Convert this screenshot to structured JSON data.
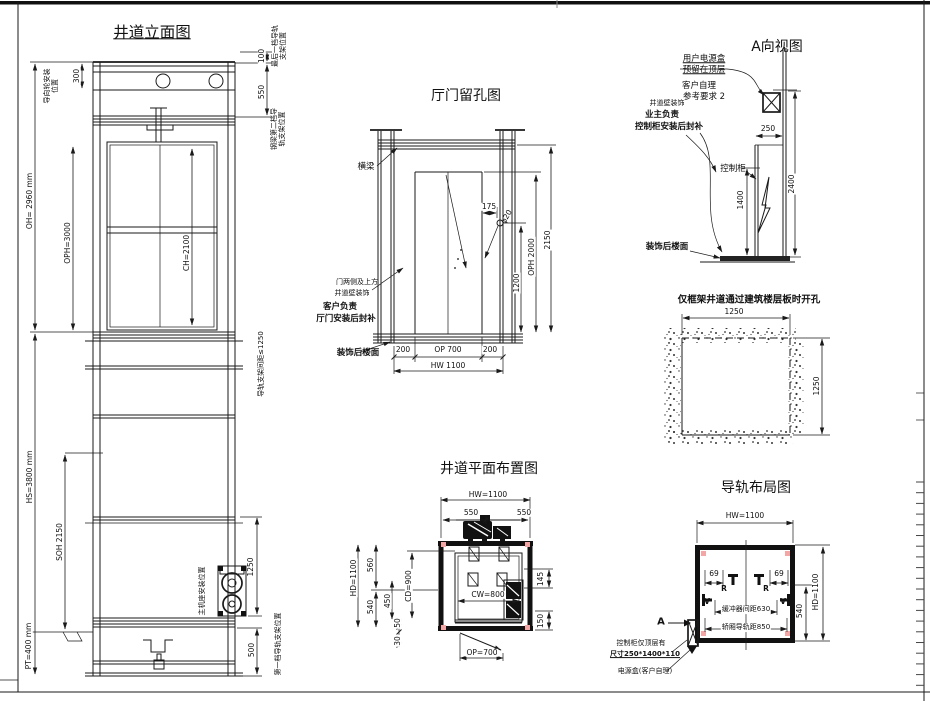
{
  "colors": {
    "line": "#1a1a1a",
    "accent_pink": "#f2a6a6",
    "background": "#ffffff"
  },
  "elevation": {
    "title": "井道立面图",
    "dims": {
      "d300": "300",
      "oh": "OH= 2960 mm",
      "oph": "OPH=3000",
      "ch": "CH=2100",
      "hs": "HS=3800 mm",
      "soh": "SOH 2150",
      "pt": "PT=400 mm",
      "d100": "100",
      "d550": "550",
      "spacing": "导轨支架间距≤1250",
      "d1250": "1250",
      "d500": "500"
    },
    "labels": {
      "guide_wheel": "导向轮安装位置",
      "last_bracket": "最后一档导轨支架位置",
      "beam2_bracket": "钢梁第二档导轨支架位置",
      "machine_seat": "主机座安装位置",
      "first_bracket": "第一档导轨支架位置"
    }
  },
  "hall": {
    "title": "厅门留孔图",
    "labels": {
      "beam": "横梁",
      "door_sides_1": "门两侧及上方",
      "door_sides_2": "井道壁装饰",
      "customer_1": "客户负责",
      "customer_2": "厅门安装后封补",
      "floor": "装饰后楼面"
    },
    "dims": {
      "d175": "175",
      "hole": "φ20",
      "d2150": "2150",
      "oph": "OPH 2000",
      "d1200": "1200",
      "d200l": "200",
      "op": "OP 700",
      "d200r": "200",
      "hw": "HW 1100"
    }
  },
  "view_a": {
    "title": "A向视图",
    "labels": {
      "power_1": "用户电源盒",
      "power_2": "预留在顶层",
      "self_1": "客户自理",
      "self_2": "参考要求 2",
      "wall_decor": "井道壁装饰",
      "owner_1": "业主负责",
      "owner_2": "控制柜安装后封补",
      "cabinet": "控制柜",
      "floor": "装饰后楼面"
    },
    "dims": {
      "d250": "250",
      "d1400": "1400",
      "d2400": "2400"
    }
  },
  "opening": {
    "title": "仅框架井道通过建筑楼层板时开孔",
    "dims": {
      "w": "1250",
      "h": "1250"
    }
  },
  "plan": {
    "title": "井道平面布置图",
    "dims": {
      "hw": "HW=1100",
      "d550l": "550",
      "d550r": "550",
      "hd": "HD=1100",
      "d560": "560",
      "d540": "540",
      "d450": "450",
      "cd": "CD=900",
      "d50": "50",
      "d30": "30",
      "cw": "CW=800",
      "d145": "145",
      "d150": "150",
      "op": "OP=700"
    }
  },
  "rails": {
    "title": "导轨布局图",
    "dims": {
      "hw": "HW=1100",
      "hd": "HD=1100",
      "d69l": "69",
      "d69r": "69",
      "d540": "540",
      "buffer": "缓冲器间距630",
      "car_rail": "轿厢导轨距850"
    },
    "labels": {
      "r1": "R",
      "r2": "R",
      "v1": "V",
      "v2": "V",
      "a": "A",
      "cab_1": "控制柜仅顶层有",
      "cab_2": "尺寸250*1400*110",
      "power": "电源盒(客户自理)"
    }
  }
}
